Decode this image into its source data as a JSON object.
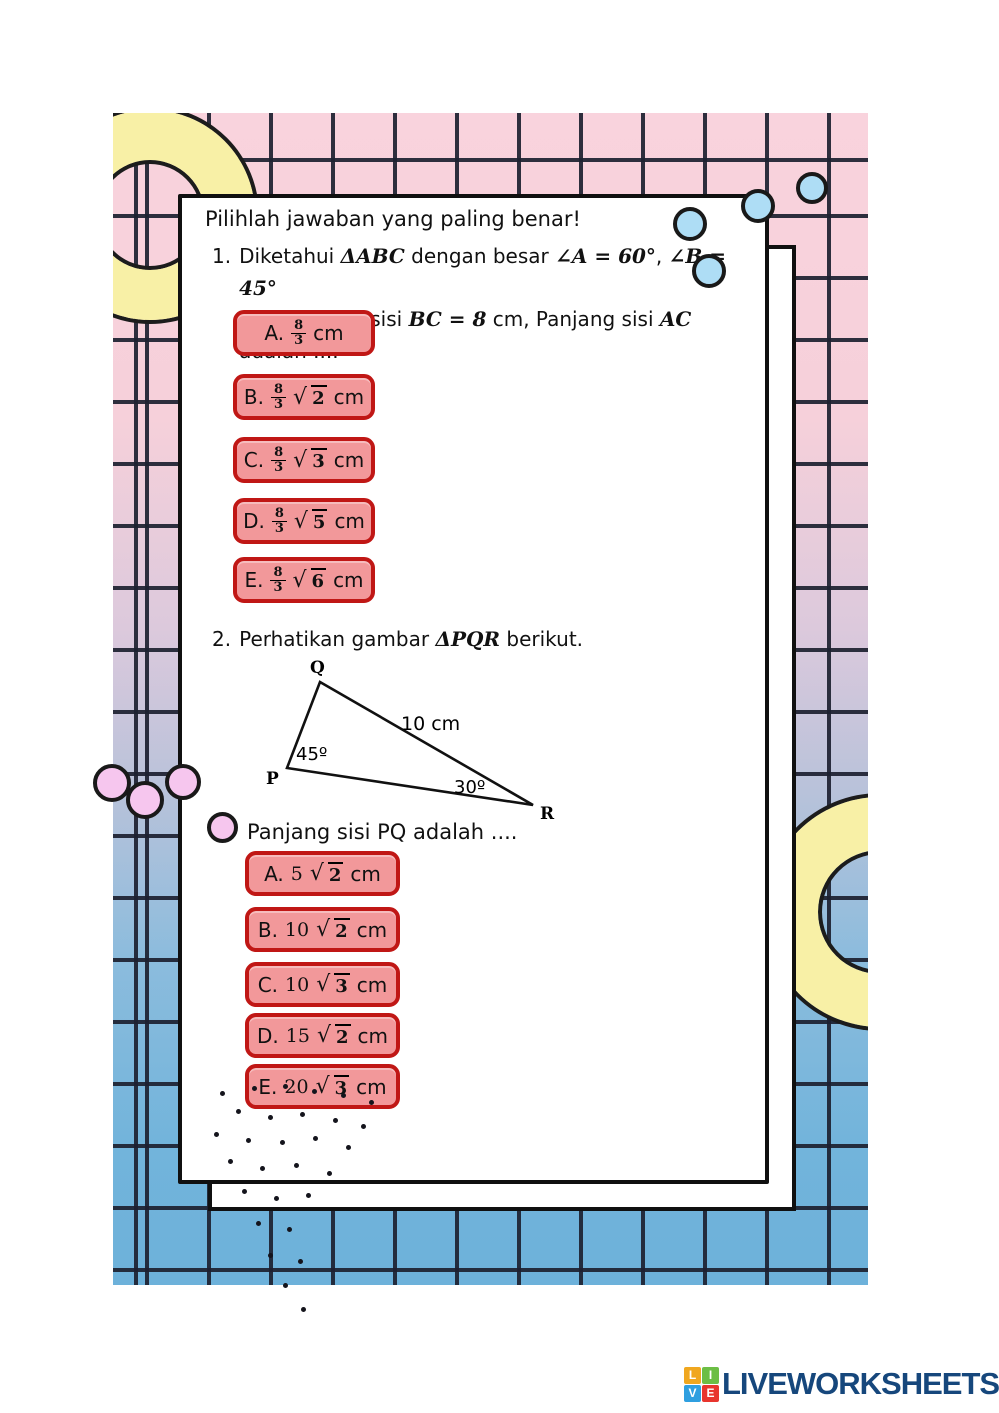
{
  "page": {
    "heading": "Pilihlah jawaban yang paling benar!",
    "q1": {
      "number": "1.",
      "t1": "Diketahui ",
      "m1": "ΔABC",
      "t2": " dengan besar ",
      "m2": "∠A = 60°",
      "t3": ", ",
      "m3": "∠B = 45°",
      "t4": "dan panjang sisi ",
      "m4": "BC = 8",
      "t5": " cm, Panjang sisi ",
      "m5": "AC",
      "t6": " adalah ....",
      "options": [
        {
          "label": "A.",
          "num": "8",
          "den": "3",
          "sqrt": "",
          "rad": "",
          "suffix": "cm"
        },
        {
          "label": "B.",
          "num": "8",
          "den": "3",
          "sqrt": "√",
          "rad": "2",
          "suffix": "cm"
        },
        {
          "label": "C.",
          "num": "8",
          "den": "3",
          "sqrt": "√",
          "rad": "3",
          "suffix": "cm"
        },
        {
          "label": "D.",
          "num": "8",
          "den": "3",
          "sqrt": "√",
          "rad": "5",
          "suffix": "cm"
        },
        {
          "label": "E.",
          "num": "8",
          "den": "3",
          "sqrt": "√",
          "rad": "6",
          "suffix": "cm"
        }
      ]
    },
    "q2": {
      "number": "2.",
      "t1": "Perhatikan gambar ",
      "m1": "ΔPQR",
      "t2": " berikut.",
      "diagram": {
        "vertexP": "P",
        "vertexQ": "Q",
        "vertexR": "R",
        "sideQR": "10 cm",
        "angleP": "45º",
        "angleR": "30º"
      },
      "prompt": "Panjang sisi PQ adalah ....",
      "options": [
        {
          "label": "A.",
          "coef": "5",
          "sqrt": "√",
          "rad": "2",
          "suffix": "cm"
        },
        {
          "label": "B.",
          "coef": "10",
          "sqrt": "√",
          "rad": "2",
          "suffix": "cm"
        },
        {
          "label": "C.",
          "coef": "10",
          "sqrt": "√",
          "rad": "3",
          "suffix": "cm"
        },
        {
          "label": "D.",
          "coef": "15",
          "sqrt": "√",
          "rad": "2",
          "suffix": "cm"
        },
        {
          "label": "E.",
          "coef": "20",
          "sqrt": "√",
          "rad": "3",
          "suffix": "cm"
        }
      ]
    },
    "logo": {
      "text": "LIVEWORKSHEETS",
      "sq1": "L",
      "sq2": "I",
      "sq3": "V",
      "sq4": "E"
    },
    "colors": {
      "button_bg": "#f2989a",
      "button_border": "#c01715",
      "logo_text": "#16477c",
      "bg_top_pink": "#f9d3dd",
      "bg_bottom_blue": "#6db1da",
      "ring_yellow": "#f8f0a6",
      "dot_blue": "#aeddf5",
      "dot_pink": "#f6c6ee"
    }
  }
}
